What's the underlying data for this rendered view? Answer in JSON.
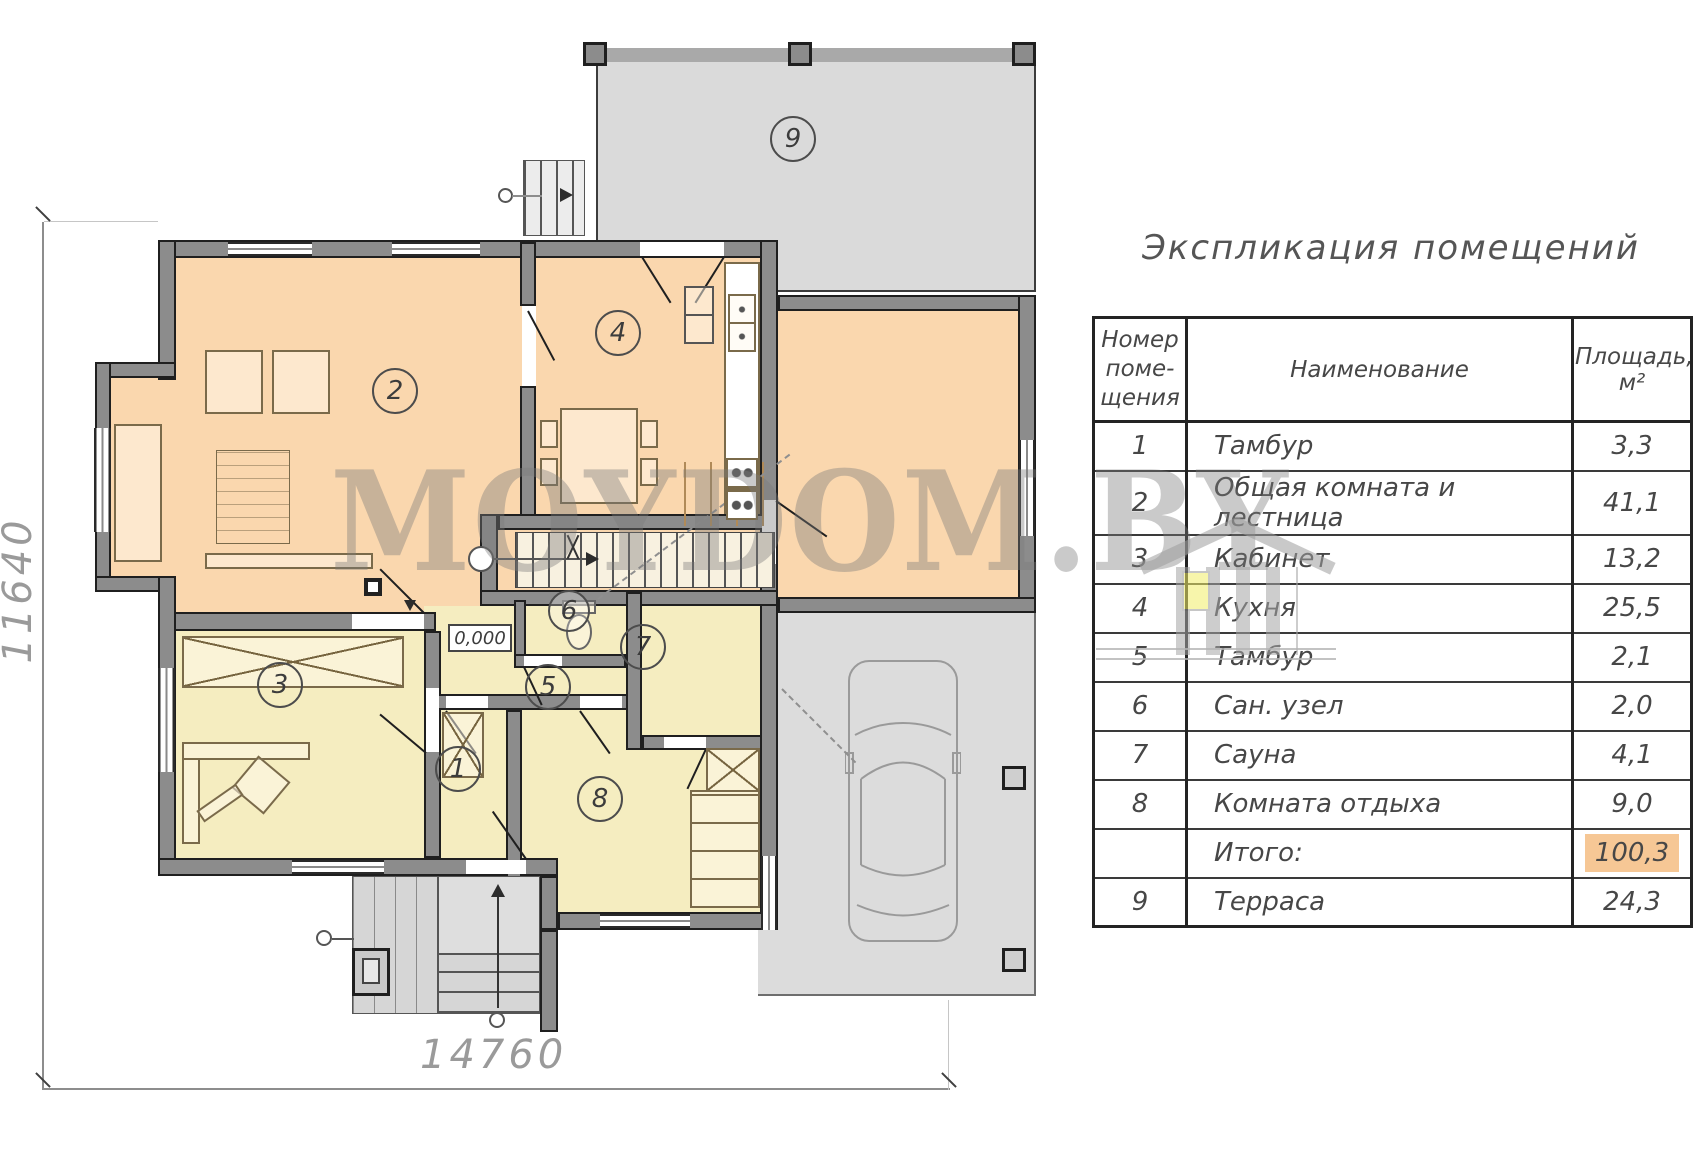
{
  "watermark": {
    "text": "MOYDOM.BY"
  },
  "plan": {
    "rooms": [
      {
        "label": "1"
      },
      {
        "label": "2"
      },
      {
        "label": "3"
      },
      {
        "label": "4"
      },
      {
        "label": "5"
      },
      {
        "label": "6"
      },
      {
        "label": "7"
      },
      {
        "label": "8"
      },
      {
        "label": "9"
      }
    ],
    "level_mark": "0,000",
    "dimensions": {
      "width": "14760",
      "height": "11640"
    }
  },
  "table": {
    "title": "Экспликация помещений",
    "headers": {
      "number": "Номер\nпоме-\nщения",
      "name": "Наименование",
      "area": "Площадь, м²"
    },
    "rows": [
      {
        "num": "1",
        "name": "Тамбур",
        "area": "3,3"
      },
      {
        "num": "2",
        "name": "Общая комната и лестница",
        "area": "41,1"
      },
      {
        "num": "3",
        "name": "Кабинет",
        "area": "13,2"
      },
      {
        "num": "4",
        "name": "Кухня",
        "area": "25,5"
      },
      {
        "num": "5",
        "name": "Тамбур",
        "area": "2,1"
      },
      {
        "num": "6",
        "name": "Сан. узел",
        "area": "2,0"
      },
      {
        "num": "7",
        "name": "Сауна",
        "area": "4,1"
      },
      {
        "num": "8",
        "name": "Комната отдыха",
        "area": "9,0"
      },
      {
        "num": "",
        "name": "Итого:",
        "area": "100,3"
      },
      {
        "num": "9",
        "name": "Терраса",
        "area": "24,3"
      }
    ]
  },
  "colors": {
    "room_warm": "#fad7ae",
    "room_light": "#f5edc0",
    "wall": "#8c8c8c",
    "outdoor": "#dcdcdc",
    "highlight": "#f6c795",
    "dim_text": "#9a9a9a",
    "watermark_grey": "#7a7a7a",
    "logo_window": "#f2ee67"
  }
}
